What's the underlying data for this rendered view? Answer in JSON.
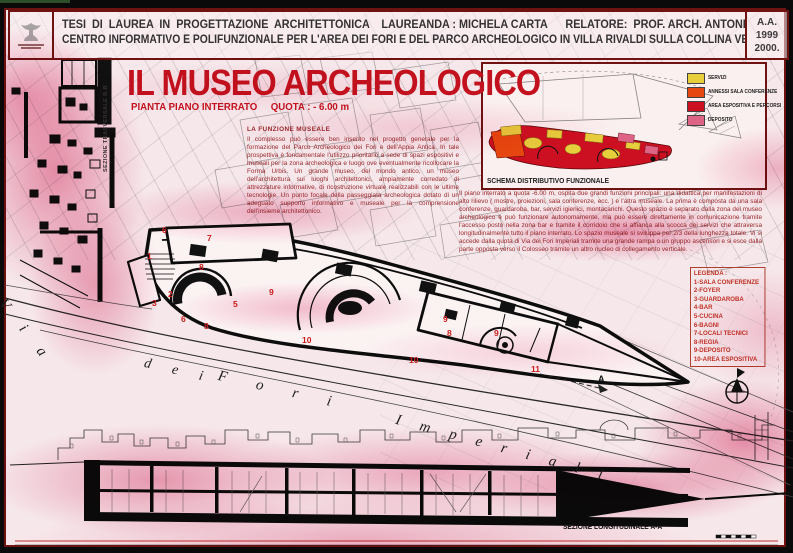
{
  "header": {
    "line1": "TESI  DI  LAUREA  IN  PROGETTAZIONE  ARCHITETTONICA    LAUREANDA : MICHELA CARTA      RELATORE:  PROF. ARCH. ANTONINO SAGGIO",
    "line2": "CENTRO INFORMATIVO E POLIFUNZIONALE PER L'AREA DEI FORI E DEL PARCO ARCHEOLOGICO IN VILLA RIVALDI SULLA COLLINA VELIA",
    "year_line1": "A.A.",
    "year_line2": "1999",
    "year_line3": "2000.",
    "logo_icon": "university-crest"
  },
  "title": {
    "main": "IL MUSEO ARCHEOLOGICO",
    "subtitle": "PIANTA PIANO INTERRATO     QUOTA : - 6.00 m"
  },
  "intro": {
    "heading": "LA FUNZIONE  MUSEALE",
    "body": "Il complesso può essere ben inserito nel progetto generale per la formazione del Parco Archeologico dei Fori e dell'Appia Antica. In tale prospettiva è fondamentale l'utilizzo prioritario a sede di spazi espositivi e museali per la zona archeologica e luogo ove eventualmente ricollocare la Forma Urbis. Un grande museo, del mondo antico, un museo dell'architettura sui luoghi architettonici, ampiamente corredato di attrezzature informative, di ricostruzione virtuale realizzabili con le ultime tecnologie. Un punto focale della passeggiata archeologica dotato di un adeguato supporto informativo e museale per la comprensione dell'insieme architettonico."
  },
  "description": {
    "body": "Il piano interrato a quota -6.00 m, ospita due grandi funzioni principali: una didattica per manifestazioni di alto rilievo ( mostre, proiezioni, sala conferenze, ecc. ) e l'altra museale. La prima è composta da una sala conferenze, guardaroba, bar, servizi igienici, montacarichi. Questo spazio è separato dalla zona del museo archeologico e può funzionare autonomamente, ma può essere direttamente in comunicazione tramite l'accesso posto nella zona bar e tramite il corridoio che si affianca alla scocca dei servizi che attraversa longitudinalmente tutto il piano interrato. Lo spazio museale si sviluppa per 2/3 della lunghezza totale. Vi si accede dalla quota di Via dei Fori Imperiali tramite una grande rampa o un gruppo ascensori e si esce dalla parte opposta verso il Colosseo tramite un altro nucleo di collegamento verticale."
  },
  "schema": {
    "caption": "SCHEMA DISTRIBUTIVO FUNZIONALE",
    "legend": [
      {
        "label": "SERVIZI",
        "color": "#e9d63e",
        "style": "background:#e9d63e"
      },
      {
        "label": "ANNESSI SALA CONFERENZE",
        "color": "#e8490f",
        "style": "background:#e8490f"
      },
      {
        "label": "AREA ESPOSITIVA E PERCORSI",
        "color": "#ce1022",
        "style": "background:#ce1022"
      },
      {
        "label": "DEPOSITO",
        "color": "#e0688a",
        "style": "background:#e0688a"
      }
    ]
  },
  "legenda": {
    "title": "LEGENDA :",
    "items": [
      "1-SALA CONFERENZE",
      "2-FOYER",
      "3-GUARDAROBA",
      "4-BAR",
      "5-CUCINA",
      "6-BAGNI",
      "7-LOCALI TECNICI",
      "8-REGIA",
      "9-DEPOSITO",
      "10-AREA ESPOSITIVA"
    ]
  },
  "plan": {
    "rooms": [
      "1",
      "6",
      "7",
      "8",
      "2",
      "3",
      "9",
      "5",
      "6",
      "8",
      "10",
      "9",
      "8",
      "9",
      "10",
      "11"
    ],
    "street": {
      "via": "V i a",
      "dei": "d e i",
      "fori": "F o r i",
      "imperiali": "I m p e r i a l i"
    },
    "section_marker": "A"
  },
  "sections": {
    "longitudinal": "SEZIONE LONGITUDINALE A-A",
    "transversal": "SEZIONE TRASVERSALE B-B"
  },
  "colors": {
    "accent_red": "#c5121f",
    "text_red": "#9a2a2e",
    "frame": "#701212"
  }
}
